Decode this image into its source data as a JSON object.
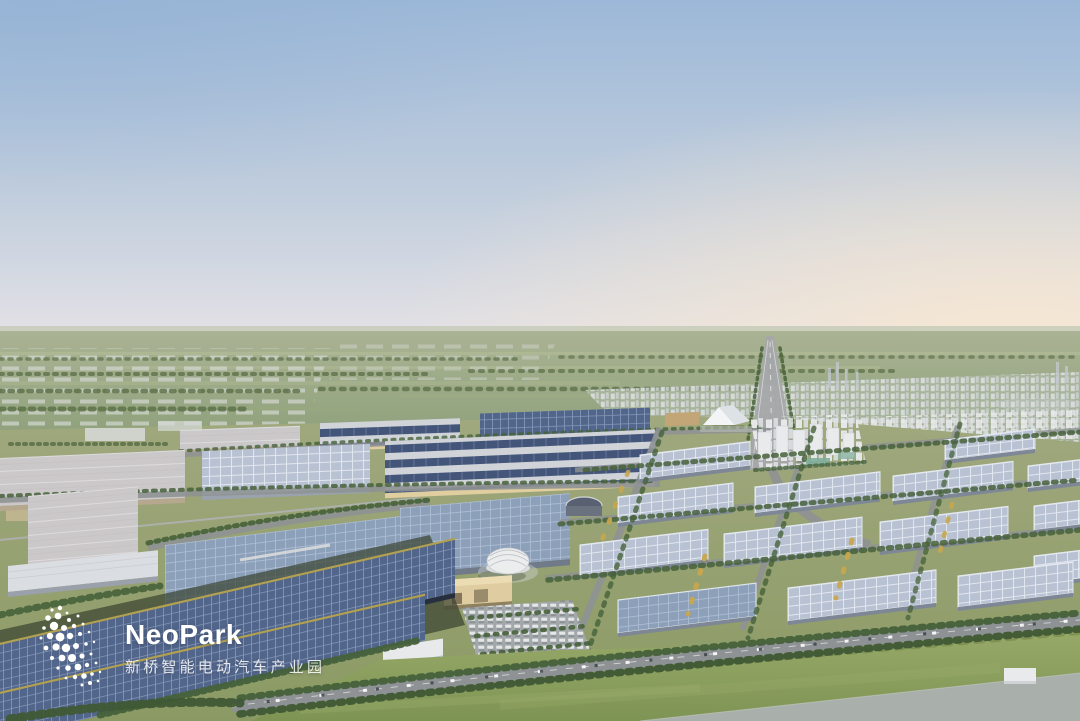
{
  "window": {
    "width": 1080,
    "height": 721
  },
  "logo": {
    "brand": "NeoPark",
    "subtitle": "新桥智能电动汽车产业园",
    "icon": "particle-swarm-icon"
  },
  "scene": {
    "type": "aerial-3d-render",
    "elements": [
      "sky",
      "warm-horizon-glow",
      "haze-band",
      "distant-plain",
      "greenhouse-rows",
      "treelines",
      "distant-pond",
      "distant-city",
      "skyline-towers",
      "highway",
      "entrance-tent",
      "residential-cluster",
      "factory-rows",
      "solar-striped-complex",
      "steel-blue-halls",
      "pale-halls",
      "warehouse-grid",
      "dome-building",
      "arc-building",
      "visitor-parking",
      "giant-solar-roofs",
      "tree-lined-avenue",
      "lawn",
      "pond-plaza"
    ]
  },
  "colors": {
    "sky_top": "#9cb8d8",
    "sky_mid": "#c0cddd",
    "sky_low": "#e6e3e6",
    "warm_glow": "#f7e7d2",
    "blue_corner": "#93b1d4",
    "haze": "#c6cbb8",
    "field_top": "#aab394",
    "field_bottom": "#8da07a",
    "ground_top": "#a0a87e",
    "ground_bottom": "#8b9a64",
    "lawn_top": "#9cad6c",
    "lawn_bottom": "#7e9454",
    "treeline": "#5a6e46",
    "tree": "#46613a",
    "tree_yellow": "#c8a64d",
    "roof_dark": "#52658a",
    "roof_dark_line": "#8ea2c2",
    "roof_mid": "#8ca0ba",
    "roof_mid_line": "#b7c6da",
    "roof_light": "#b9c2d3",
    "roof_light_line": "#e4e9f0",
    "roof_pale": "#cbc8ca",
    "roof_pale_line": "#dedbdd",
    "stripe_deck": "#d0d4d9",
    "stripe_band": "#44557a",
    "wall_tan": "#c2a678",
    "wall_tan_light": "#e0cda0",
    "wall_slate": "#7e8795",
    "road": "#8e9294",
    "white_bldg": "#e9eaec",
    "city_white": "#dde0e2",
    "dome": "#eceded",
    "water": "#a9afaa",
    "gold": "#b1a050",
    "shadow_green": "#39422f",
    "car_white": "#eef0f2",
    "logo_text": "#ffffff"
  }
}
